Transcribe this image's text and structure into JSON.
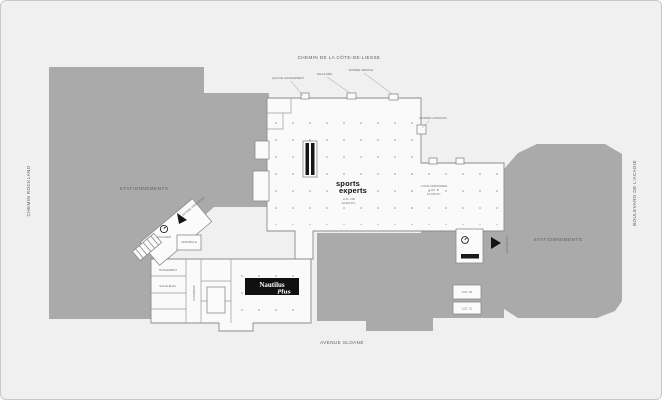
{
  "map": {
    "streets": {
      "top": "CHEMIN DE LA CÔTE-DE-LIESSE",
      "left": "CHEMIN ROCKLAND",
      "right": "BOULEVARD DE L'ACADIE",
      "bottom": "AVENUE SLOANE"
    },
    "parking": {
      "left_label": "STATIONNEMENTS",
      "right_label": "STATIONNEMENTS"
    },
    "stores": {
      "sports_experts": {
        "line1": "sports",
        "line2": "experts",
        "loc": "LOC. 200",
        "area": "42,000 P.C."
      },
      "nautilus": {
        "name": "Nautilus",
        "script": "Plus",
        "loc": "LOC. 110",
        "area": "34,000 P.C."
      }
    },
    "callouts": {
      "c1": "QUAI DE CHARGEMENT",
      "c2": "SALLE MÉC.",
      "c3": "ENTRÉE SERVICE",
      "c4": "ENTRÉE LIVRAISON",
      "c5": "LOCAL DISPONIBLE",
      "c6": "LOC. B",
      "c7": "10,765 P.C.",
      "c12": "SALLE ÉLEC.",
      "c13": "RANGEMENT",
      "c14": "CORRIDOR",
      "c15": "ENTRÉE PRINCIPALE",
      "c16": "VESTIBULE",
      "c17": "ENTRÉE EST",
      "c18": "LOC. 50",
      "c19": "LOC. 51",
      "c20": "ESCALIER"
    },
    "colors": {
      "background": "#f0f0f1",
      "parking": "#aaaaaa",
      "building": "#fafafa",
      "outline": "#8b8b8b",
      "ink": "#151515"
    }
  }
}
